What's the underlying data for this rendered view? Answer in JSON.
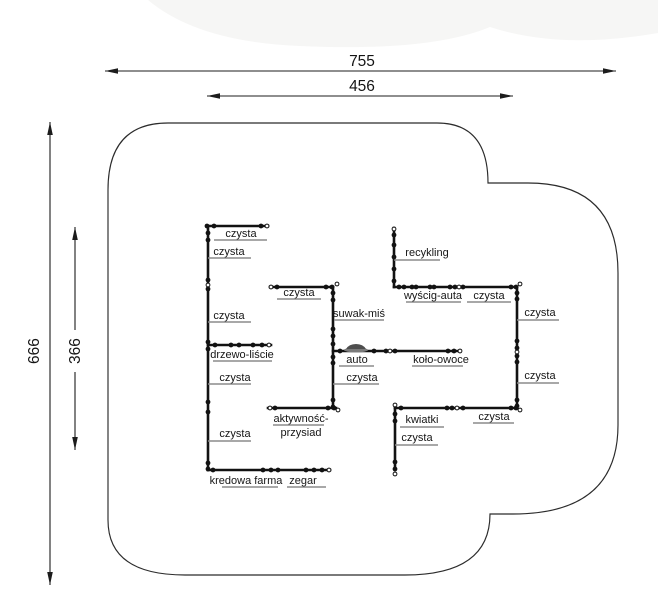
{
  "drawing": {
    "title": "playground-panel-layout-plan",
    "colors": {
      "background": "#ffffff",
      "line": "#121212",
      "outline": "#2b2b2b",
      "leader_gray": "#8c8c8c",
      "top_band": "#f6f6f5"
    },
    "dimensions": {
      "total_width": {
        "value": "755"
      },
      "inner_width": {
        "value": "456"
      },
      "total_height": {
        "value": "666"
      },
      "inner_height": {
        "value": "366"
      }
    },
    "icons": [
      {
        "name": "car-icon"
      },
      {
        "name": "junction-dot"
      },
      {
        "name": "junction-node-circle"
      },
      {
        "name": "dimension-arrowhead"
      }
    ],
    "labels": [
      {
        "id": "panel-czysta-1",
        "text": "czysta"
      },
      {
        "id": "panel-czysta-2",
        "text": "czysta"
      },
      {
        "id": "panel-czysta-3",
        "text": "czysta"
      },
      {
        "id": "panel-drzewo-liscie",
        "text": "drzewo-liście"
      },
      {
        "id": "panel-czysta-4",
        "text": "czysta"
      },
      {
        "id": "panel-czysta-5",
        "text": "czysta"
      },
      {
        "id": "panel-kredowa-farma",
        "text": "kredowa farma"
      },
      {
        "id": "panel-zegar",
        "text": "zegar"
      },
      {
        "id": "panel-czysta-6",
        "text": "czysta"
      },
      {
        "id": "panel-suwak-mis",
        "text": "suwak-miś"
      },
      {
        "id": "panel-auto",
        "text": "auto"
      },
      {
        "id": "panel-czysta-7",
        "text": "czysta"
      },
      {
        "id": "panel-kolo-owoce",
        "text": "koło-owoce"
      },
      {
        "id": "panel-aktywnosc",
        "text": "aktywność-"
      },
      {
        "id": "panel-przysiad",
        "text": "przysiad"
      },
      {
        "id": "panel-recykling",
        "text": "recykling"
      },
      {
        "id": "panel-wyscig-auta",
        "text": "wyścig-auta"
      },
      {
        "id": "panel-czysta-8",
        "text": "czysta"
      },
      {
        "id": "panel-czysta-9",
        "text": "czysta"
      },
      {
        "id": "panel-czysta-10",
        "text": "czysta"
      },
      {
        "id": "panel-czysta-11",
        "text": "czysta"
      },
      {
        "id": "panel-kwiatki",
        "text": "kwiatki"
      },
      {
        "id": "panel-czysta-12",
        "text": "czysta"
      }
    ]
  }
}
